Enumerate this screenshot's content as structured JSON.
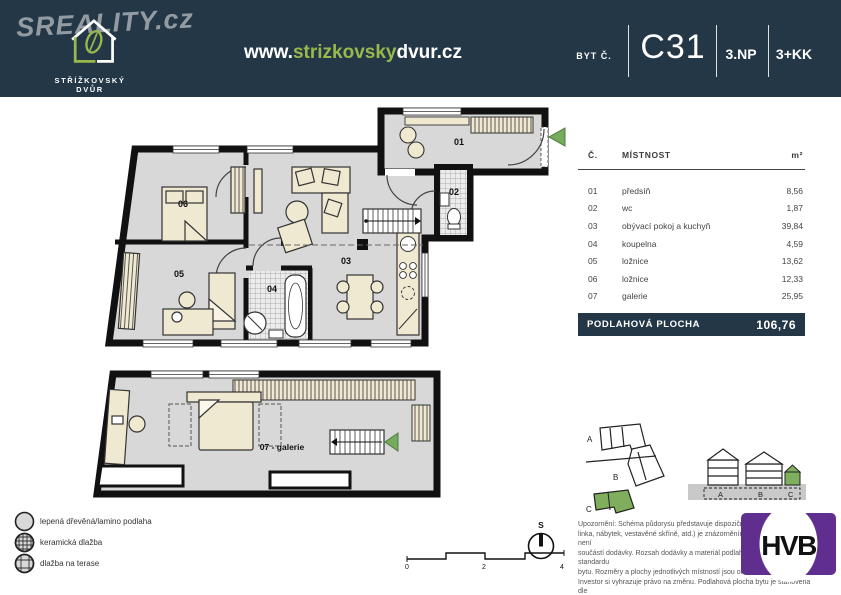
{
  "colors": {
    "navy": "#233747",
    "url_green": "#9ab84c",
    "arrow_green": "#76ab5e",
    "hvb_purple": "#5f2e8e",
    "plan_gray": "#d8d8d8",
    "furniture_beige": "#f0e9d2"
  },
  "header": {
    "watermark": "SREALITY.cz",
    "brand": "STŘÍŽKOVSKÝ DVŮR",
    "url_www": "www.",
    "url_name": "strizkovsky",
    "url_tail": "dvur.cz",
    "unit_label": "BYT Č.",
    "unit_number": "C31",
    "floor": "3.NP",
    "layout": "3+KK"
  },
  "plan": {
    "labels": {
      "r01": "01",
      "r02": "02",
      "r03": "03",
      "r04": "04",
      "r05": "05",
      "r06": "06",
      "galerie": "07 - galerie"
    }
  },
  "table": {
    "col_num": "Č.",
    "col_room": "MÍSTNOST",
    "col_area": "m²",
    "rows": [
      {
        "num": "01",
        "room": "předsíň",
        "area": "8,56"
      },
      {
        "num": "02",
        "room": "wc",
        "area": "1,87"
      },
      {
        "num": "03",
        "room": "obývací pokoj  a kuchyň",
        "area": "39,84"
      },
      {
        "num": "04",
        "room": "koupelna",
        "area": "4,59"
      },
      {
        "num": "05",
        "room": "ložnice",
        "area": "13,62"
      },
      {
        "num": "06",
        "room": "ložnice",
        "area": "12,33"
      },
      {
        "num": "07",
        "room": "galerie",
        "area": "25,95"
      }
    ],
    "total_label": "PODLAHOVÁ PLOCHA",
    "total_value": "106,76"
  },
  "legend": {
    "items": [
      {
        "label": "lepená dřevěná/lamino podlaha"
      },
      {
        "label": "keramická dlažba"
      },
      {
        "label": "dlažba na terase"
      }
    ]
  },
  "note": {
    "lines": [
      "Upozornění: Schéma půdorysu představuje dispoziční řešení (kuchyňská",
      "linka, nábytek, vestavěné skříně, atd.) je znázorněním možného řešení a není",
      "součástí dodávky. Rozsah dodávky a materiál podlah je specifikován ve standardu",
      "bytu. Rozměry a plochy jednotlivých místností jsou orientační.",
      "Investor si vyhrazuje právo na změnu. Podlahová plocha bytu je stanovena dle",
      "právních předpisů (nařízení vlády č. 366/2013 Sb.)."
    ]
  },
  "site": {
    "letters": [
      "A",
      "B",
      "C"
    ]
  },
  "elevation": {
    "letters": [
      "A",
      "B",
      "C"
    ]
  },
  "compass": {
    "label": "S"
  },
  "scale": {
    "ticks": [
      "0",
      "2",
      "4"
    ]
  },
  "hvb": {
    "text": "HVB"
  }
}
